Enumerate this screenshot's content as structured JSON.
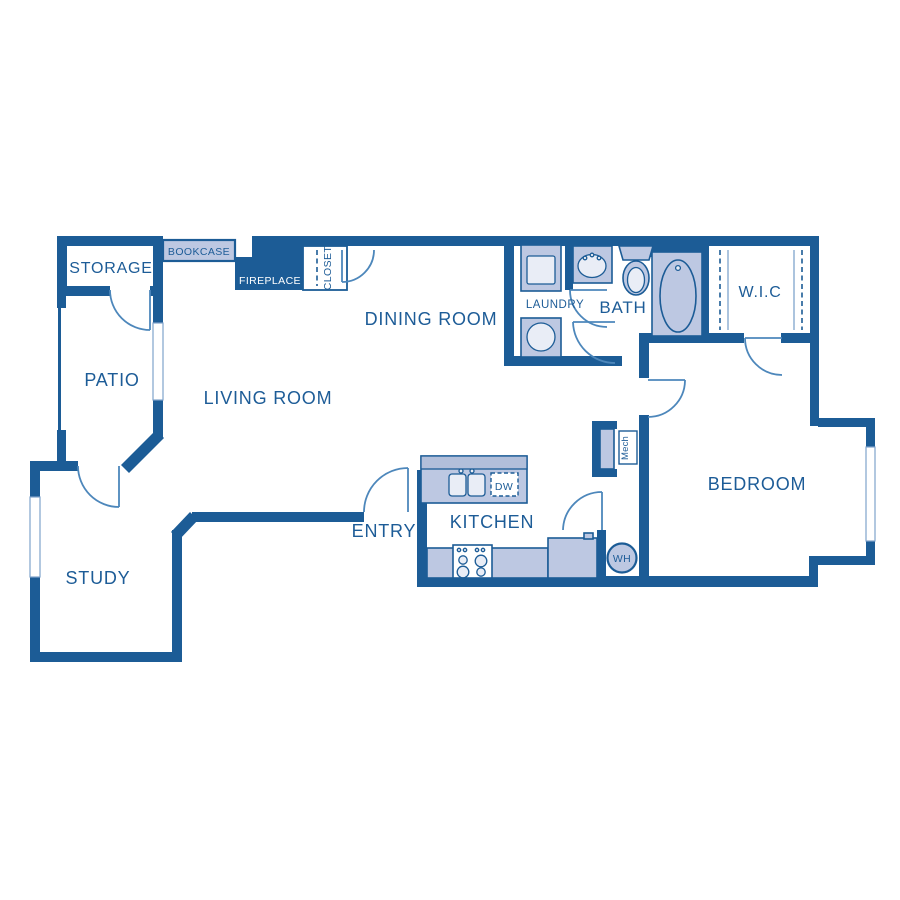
{
  "title": "Apartment floor plan",
  "colors": {
    "wall": "#1c5c96",
    "fixture_fill": "#bdc8e2",
    "fixture_fill_band": "#b2bfda",
    "fixture_fill_light": "#e9edf6",
    "door_swing": "#4d87bb",
    "thin_line": "#7fa3cc",
    "label_text": "#1d5c97",
    "fireplace_label_text": "#ffffff",
    "background": "#ffffff"
  },
  "rooms": {
    "storage": {
      "label": "STORAGE"
    },
    "patio": {
      "label": "PATIO"
    },
    "living_room": {
      "label": "LIVING ROOM"
    },
    "dining_room": {
      "label": "DINING ROOM"
    },
    "laundry": {
      "label": "LAUNDRY"
    },
    "bath": {
      "label": "BATH"
    },
    "wic": {
      "label": "W.I.C"
    },
    "bedroom": {
      "label": "BEDROOM"
    },
    "kitchen": {
      "label": "KITCHEN"
    },
    "entry": {
      "label": "ENTRY"
    },
    "study": {
      "label": "STUDY"
    }
  },
  "features": {
    "bookcase": {
      "label": "BOOKCASE"
    },
    "fireplace": {
      "label": "FIREPLACE"
    },
    "closet": {
      "label": "CLOSET"
    },
    "dishwasher": {
      "label": "DW"
    },
    "mechanical": {
      "label": "Mech"
    },
    "water_heater": {
      "label": "WH"
    }
  }
}
